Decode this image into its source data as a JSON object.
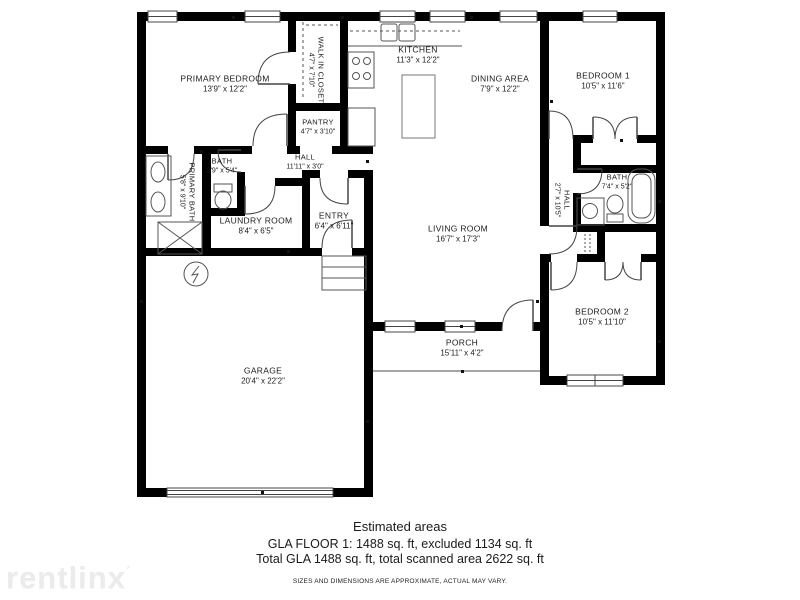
{
  "colors": {
    "wall": "#000000",
    "background": "#ffffff",
    "line": "#555555",
    "watermark": "#ebebeb"
  },
  "rooms": {
    "primary_bedroom": {
      "name": "PRIMARY BEDROOM",
      "dims": "13'9\" x 12'2\""
    },
    "walk_in_closet": {
      "name": "WALK IN CLOSET",
      "dims": "4'7\" x 7'10\""
    },
    "pantry": {
      "name": "PANTRY",
      "dims": "4'7\" x 3'10\""
    },
    "kitchen": {
      "name": "KITCHEN",
      "dims": "11'3\" x 12'2\""
    },
    "dining_area": {
      "name": "DINING AREA",
      "dims": "7'9\" x 12'2\""
    },
    "bedroom_1": {
      "name": "BEDROOM 1",
      "dims": "10'5\" x 11'6\""
    },
    "hall_left": {
      "name": "HALL",
      "dims": "11'11\" x 3'0\""
    },
    "primary_bath": {
      "name": "PRIMARY BATH",
      "dims": "5'8\" x 9'10\""
    },
    "bath_left": {
      "name": "BATH",
      "dims": "2'9\" x 5'4\""
    },
    "laundry_room": {
      "name": "LAUNDRY ROOM",
      "dims": "8'4\" x 6'5\""
    },
    "entry": {
      "name": "ENTRY",
      "dims": "6'4\" x 6'11\""
    },
    "living_room": {
      "name": "LIVING ROOM",
      "dims": "16'7\" x 17'3\""
    },
    "hall_right": {
      "name": "HALL",
      "dims": "2'7\" x 10'5\""
    },
    "bath_right": {
      "name": "BATH",
      "dims": "7'4\" x 5'2\""
    },
    "bedroom_2": {
      "name": "BEDROOM 2",
      "dims": "10'5\" x 11'10\""
    },
    "porch": {
      "name": "PORCH",
      "dims": "15'11\" x 4'2\""
    },
    "garage": {
      "name": "GARAGE",
      "dims": "20'4\" x 22'2\""
    }
  },
  "footer": {
    "heading": "Estimated areas",
    "line1": "GLA FLOOR 1: 1488 sq. ft, excluded 1134 sq. ft",
    "line2": "Total GLA 1488 sq. ft, total scanned area 2622 sq. ft",
    "disclaimer": "SIZES AND DIMENSIONS ARE APPROXIMATE, ACTUAL MAY VARY."
  },
  "watermark": {
    "text": "rentlinx",
    "mark": "´"
  }
}
